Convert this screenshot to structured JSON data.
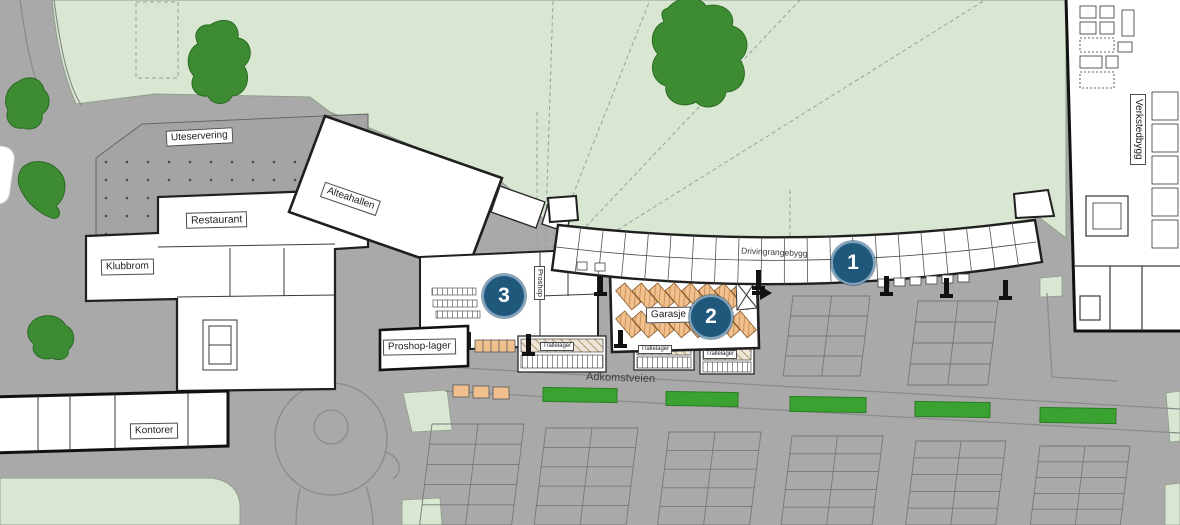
{
  "plan": {
    "type": "architectural-site-plan",
    "area_labels": {
      "uteservering": "Uteservering",
      "restaurant": "Restaurant",
      "klubbrom": "Klubbrom",
      "alteahallen": "Alteahallen",
      "proshop": "Proshop",
      "proshop_lager": "Proshop-lager",
      "garasje": "Garasje",
      "trallelager_1": "Trallelager",
      "trallelager_2": "Trallelager",
      "trallelager_3": "Trallelager",
      "kontorer": "Kontorer",
      "drivingrangebygg": "Drivingrangebygg",
      "adkomstveien": "Adkomstveien",
      "verkstedbygg": "Verkstedbygg"
    },
    "markers": [
      {
        "number": "1"
      },
      {
        "number": "2"
      },
      {
        "number": "3"
      }
    ],
    "colors": {
      "grass": "#d9e7d2",
      "tree": "#3d8b33",
      "hedge": "#3aa230",
      "pavement": "#a9a9a9",
      "building": "#ffffff",
      "outline": "#1f1f1f",
      "marker_blue": "#20587c",
      "cart_tan": "#f0c08e"
    }
  }
}
